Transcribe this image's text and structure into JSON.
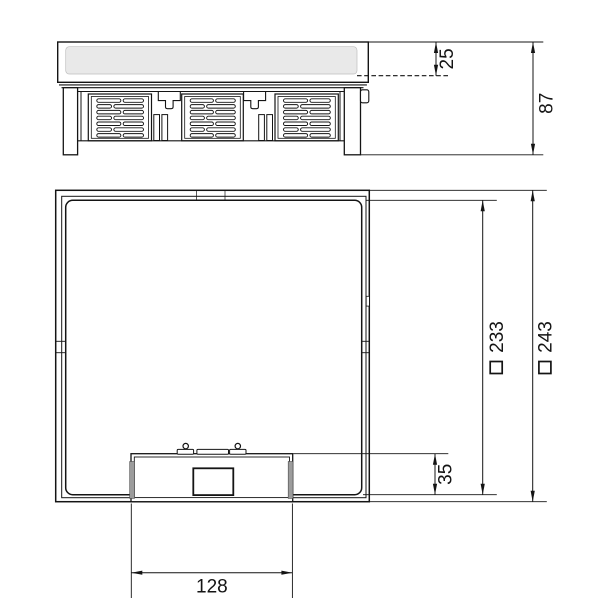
{
  "drawing": {
    "labels": {
      "recess_depth": "25",
      "overall_height": "87",
      "inner_square_size": "233",
      "outer_square_size": "243",
      "cover_edge_offset": "35",
      "outlet_unit_width": "128"
    },
    "symbols": {
      "square": "□"
    },
    "colors": {
      "line": "#141414",
      "lid_fill": "#e9e9e9",
      "shade_fill": "#9c9c9c",
      "background": "#ffffff"
    }
  }
}
